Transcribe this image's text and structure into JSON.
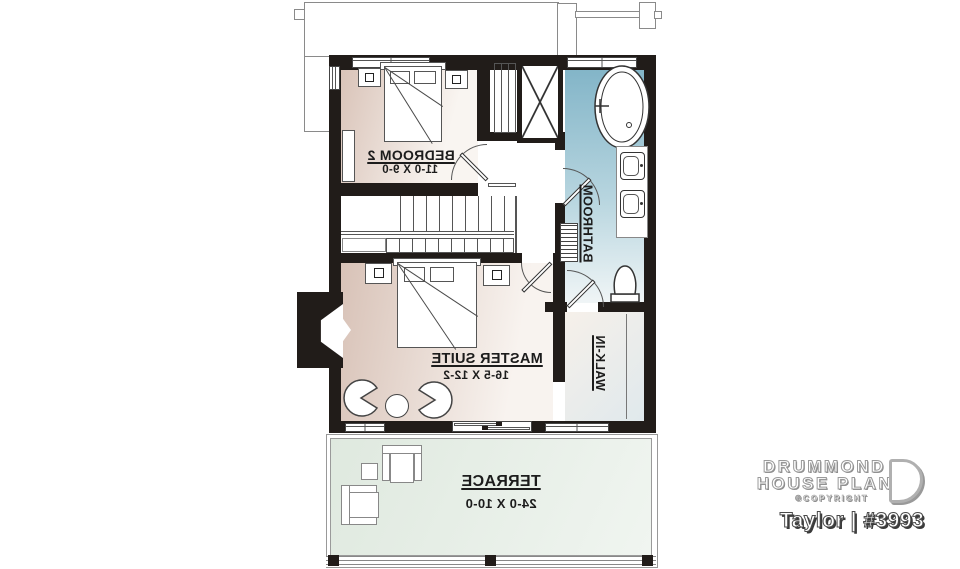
{
  "rooms": {
    "bedroom2": {
      "label": "BEDROOM 2",
      "dims": "11-0 X 9-0"
    },
    "master_suite": {
      "label": "MASTER SUITE",
      "dims": "16-5 X 12-2"
    },
    "bathroom": {
      "label": "BATHROOM"
    },
    "walk_in": {
      "label": "WALK-IN"
    },
    "terrace": {
      "label": "TERRACE",
      "dims": "24-0 X 10-0"
    }
  },
  "branding": {
    "line1": "DRUMMOND",
    "line2": "HOUSE PLANS",
    "copyright": "©COPYRIGHT",
    "plan_title": "Taylor | #3993"
  },
  "colors": {
    "wall": "#211c19",
    "bedroom_fill": "#d9c3b8",
    "bathroom_fill": "#83b5c8",
    "walk_in_fill": "#e4edef",
    "terrace_fill": "#dfe9df"
  }
}
